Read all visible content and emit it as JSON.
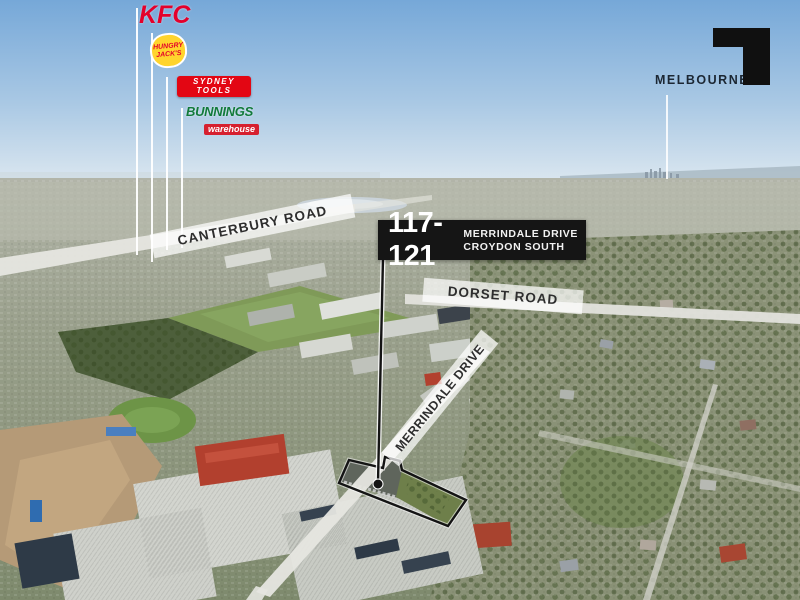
{
  "scene": {
    "description": "Aerial marketing photograph of an industrial/residential suburb with property boundary outline and point-of-interest leader lines"
  },
  "logos": {
    "kfc": {
      "label": "KFC",
      "color": "#e4002b"
    },
    "hungry_jacks": {
      "line1": "HUNGRY",
      "line2": "JACK'S",
      "bg": "#ffd42d",
      "text_color": "#e4002b"
    },
    "sydney_tools": {
      "line1": "SYDNEY",
      "line2": "TOOLS",
      "bg": "#e30613",
      "text_color": "#ffffff"
    },
    "bunnings": {
      "brand": "BUNNINGS",
      "sub": "warehouse",
      "brand_color": "#117a3b",
      "sub_bg": "#d6202f"
    }
  },
  "city_label": {
    "text": "MELBOURNE C",
    "color": "#1c2733"
  },
  "address_badge": {
    "number": "117-121",
    "line1": "MERRINDALE DRIVE",
    "line2": "CROYDON SOUTH",
    "bg": "#151515",
    "text_color": "#ffffff"
  },
  "roads": {
    "canterbury": {
      "label": "CANTERBURY ROAD"
    },
    "dorset": {
      "label": "DORSET ROAD"
    },
    "merrindale": {
      "label": "MERRINDALE DRIVE"
    }
  },
  "boundary": {
    "color": "#141414"
  }
}
